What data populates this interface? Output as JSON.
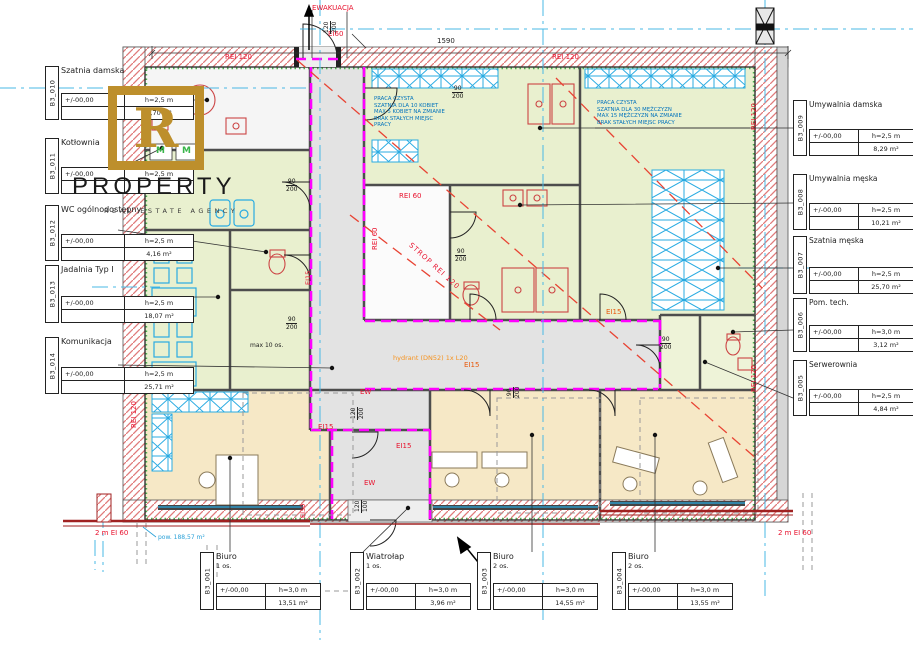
{
  "watermark": {
    "letter": "R",
    "title": "PROPERTY",
    "subtitle": "REAL ESTATE AGENCY"
  },
  "fire": {
    "rei120": "REI 120",
    "rei60": "REI 60",
    "strop_rei120": "STROP REI 120",
    "ei15": "EI15",
    "ei30": "EI30",
    "ei60": "EI60",
    "ew": "EW",
    "strip_2m": "2 m EI 60",
    "ewakuacja": "EWAKUACJA"
  },
  "dims": {
    "total": "1590",
    "h188": "1,88",
    "w90": "90",
    "h200": "200",
    "w120": "120",
    "h100": "100"
  },
  "notes": {
    "hydrant": "hydrant (DN52) 1x L20",
    "boiler": "kocioł do 30kW",
    "max_occupancy": "max 10 os.",
    "area_note": "pow. 188,57 m²",
    "marker_m": "M",
    "women": [
      "PRACA CZYSTA",
      "SZATNIA DLA 10 KOBIET",
      "MAX 5 KOBIET NA ZMIANIE",
      "BRAK STAŁYCH MIEJSC",
      "PRACY"
    ],
    "men": [
      "PRACA CZYSTA",
      "SZATNIA DLA 30 MĘŻCZYZN",
      "MAX 15 MĘŻCZYZN NA ZMIANIE",
      "BRAK STAŁYCH MIEJSC PRACY"
    ]
  },
  "callouts_left": [
    {
      "id": "B3_010",
      "name": "Szatnia damska",
      "level": "+/-00,00",
      "height": "h=2,5 m",
      "area": "5,70 m²"
    },
    {
      "id": "B3_011",
      "name": "Kotłownia",
      "level": "+/-00,00",
      "height": "h=2,5 m",
      "area": ""
    },
    {
      "id": "B3_012",
      "name": "WC ogólnodostępny",
      "level": "+/-00,00",
      "height": "h=2,5 m",
      "area": "4,16 m²"
    },
    {
      "id": "B3_013",
      "name": "Jadalnia Typ I",
      "level": "+/-00,00",
      "height": "h=2,5 m",
      "area": "18,07 m²"
    },
    {
      "id": "B3_014",
      "name": "Komunikacja",
      "level": "+/-00,00",
      "height": "h=2,5 m",
      "area": "25,71 m²"
    }
  ],
  "callouts_right": [
    {
      "id": "B3_009",
      "name": "Umywalnia damska",
      "level": "+/-00,00",
      "height": "h=2,5 m",
      "area": "8,29 m²"
    },
    {
      "id": "B3_008",
      "name": "Umywalnia męska",
      "level": "+/-00,00",
      "height": "h=2,5 m",
      "area": "10,21 m²"
    },
    {
      "id": "B3_007",
      "name": "Szatnia męska",
      "level": "+/-00,00",
      "height": "h=2,5 m",
      "area": "25,70 m²"
    },
    {
      "id": "B3_006",
      "name": "Pom. tech.",
      "level": "+/-00,00",
      "height": "h=3,0 m",
      "area": "3,12 m²"
    },
    {
      "id": "B3_005",
      "name": "Serwerownia",
      "level": "+/-00,00",
      "height": "h=2,5 m",
      "area": "4,84 m²"
    }
  ],
  "callouts_bottom": [
    {
      "id": "B3_001",
      "name": "Biuro",
      "occ": "1 os.",
      "level": "+/-00,00",
      "height": "h=3,0 m",
      "area": "13,51 m²"
    },
    {
      "id": "B3_002",
      "name": "Wiatrołap",
      "occ": "1 os.",
      "level": "+/-00,00",
      "height": "h=3,0 m",
      "area": "3,96 m²"
    },
    {
      "id": "B3_003",
      "name": "Biuro",
      "occ": "2 os.",
      "level": "+/-00,00",
      "height": "h=3,0 m",
      "area": "14,55 m²"
    },
    {
      "id": "B3_004",
      "name": "Biuro",
      "occ": "2 os.",
      "level": "+/-00,00",
      "height": "h=3,0 m",
      "area": "13,55 m²"
    }
  ],
  "colors": {
    "accent_gold": "#bd8f2c",
    "fire_red": "#e8112d",
    "safety_orange": "#f6921e",
    "cad_blue": "#29abe2",
    "note_blue": "#0072bc",
    "magenta_ei": "#ff00ff",
    "room_green": "#e9f0cf",
    "room_beige": "#f6e8c6",
    "corridor_gray": "#e3e3e3"
  }
}
